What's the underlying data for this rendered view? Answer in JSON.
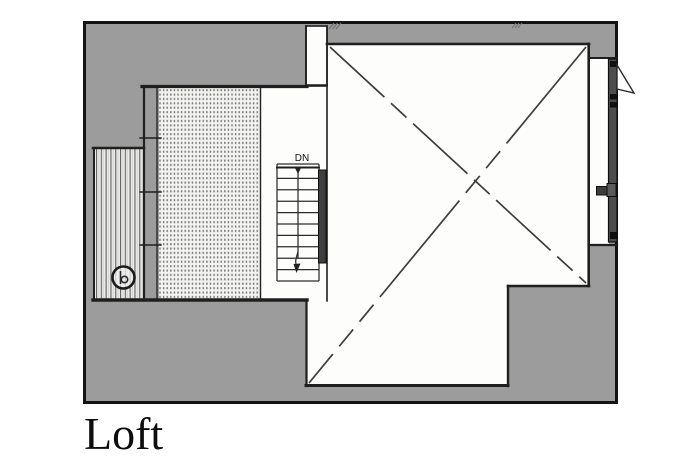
{
  "title": {
    "label": "Loft"
  },
  "stair": {
    "label": "DN",
    "direction": "down",
    "treads": 10
  },
  "colors": {
    "paper": "#ffffff",
    "plan_gray": "#9c9c9c",
    "outline": "#141414",
    "wall_line": "#1f1f1f",
    "frame_dark": "#4d4d4d",
    "diagonal": "#3d3d3d",
    "title_ink": "#0d0d0d"
  },
  "legend": {
    "open_area_marker": "dashed-x",
    "loft_floor_texture": "stipple-dots",
    "deck_texture": "vertical-planks"
  }
}
